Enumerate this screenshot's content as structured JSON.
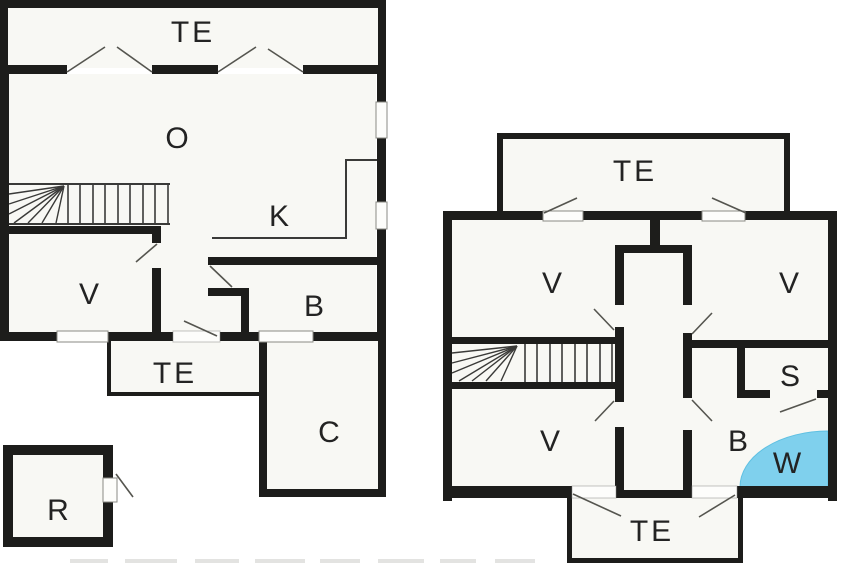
{
  "document": {
    "type": "floor-plan-drawing",
    "plans_count": 2,
    "background": "#ffffff"
  },
  "colors": {
    "wall": "#1d1d1b",
    "thin_line": "#3a3a38",
    "door_swing": "#55554f",
    "opening_frame": "#8a8a85",
    "room_fill": "#f8f8f4",
    "shower_fill": "#7fd0ed",
    "shower_edge": "#5fc0e2",
    "label": "#232323",
    "background": "#ffffff"
  },
  "plan1": {
    "name": "left-floor-plan",
    "rooms": [
      {
        "id": "terrace-top",
        "label": "TE"
      },
      {
        "id": "living-room",
        "label": "O"
      },
      {
        "id": "kitchen",
        "label": "K"
      },
      {
        "id": "bedroom",
        "label": "V"
      },
      {
        "id": "bathroom",
        "label": "B"
      },
      {
        "id": "terrace-side",
        "label": "TE"
      },
      {
        "id": "garage",
        "label": "C"
      },
      {
        "id": "outbuilding",
        "label": "R"
      }
    ]
  },
  "plan2": {
    "name": "right-floor-plan",
    "rooms": [
      {
        "id": "terrace-top",
        "label": "TE"
      },
      {
        "id": "bedroom-top-left",
        "label": "V"
      },
      {
        "id": "bedroom-top-right",
        "label": "V"
      },
      {
        "id": "bedroom-bottom-left",
        "label": "V"
      },
      {
        "id": "storage",
        "label": "S"
      },
      {
        "id": "bathroom",
        "label": "B"
      },
      {
        "id": "shower-corner",
        "label": "W"
      },
      {
        "id": "terrace-bottom",
        "label": "TE"
      }
    ]
  }
}
